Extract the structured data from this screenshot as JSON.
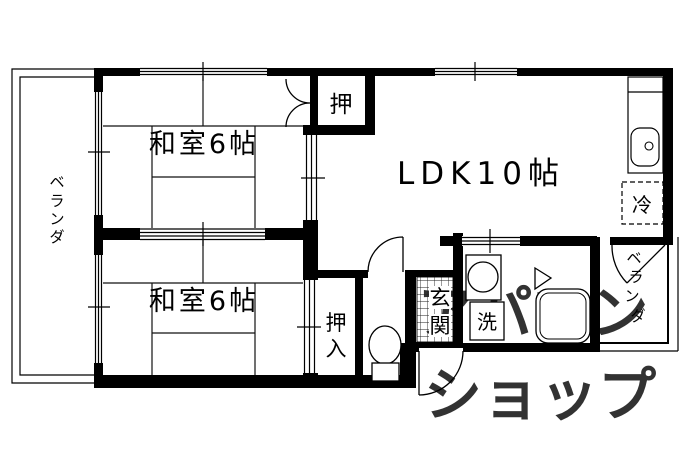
{
  "plan": {
    "room1_label": "和室6帖",
    "room2_label": "和室6帖",
    "ldk_label": "LDK10帖",
    "closet_top_label": "押",
    "closet_bottom_chars": [
      "押",
      "入"
    ],
    "entrance_chars": [
      "玄",
      "関"
    ],
    "laundry_label": "洗",
    "fridge_label": "冷",
    "veranda_left_chars": [
      "ベ",
      "ラ",
      "ン",
      "ダ"
    ],
    "veranda_right_chars": [
      "ベ",
      "ラ",
      "ン",
      "ダ"
    ]
  },
  "watermark": {
    "line1": "アパマン",
    "line2": "ショップ",
    "color": "#c6c0d8"
  },
  "colors": {
    "wall": "#000000",
    "background": "#ffffff"
  }
}
